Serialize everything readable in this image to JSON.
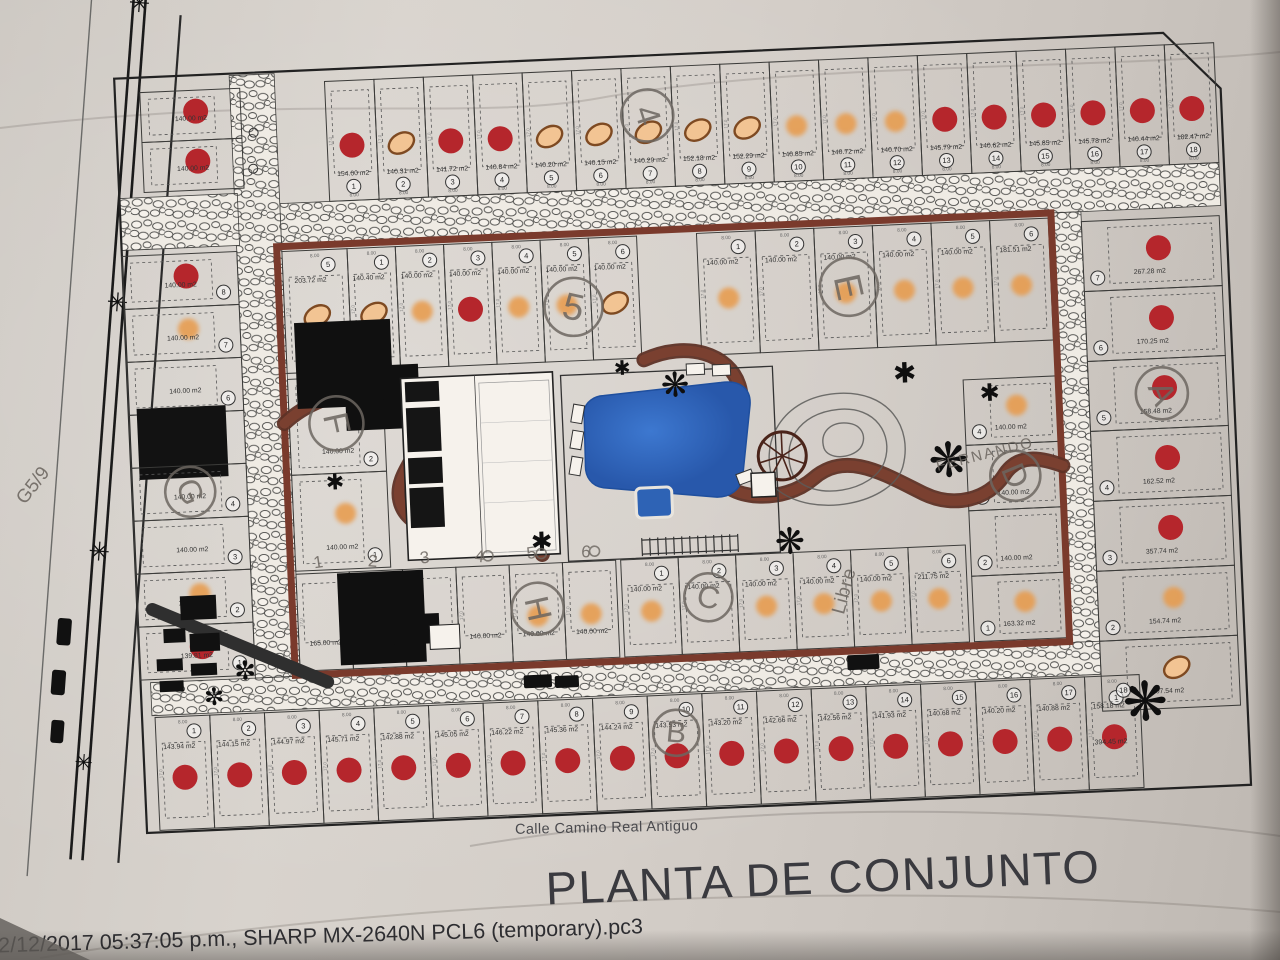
{
  "plan": {
    "title": "PLANTA DE CONJUNTO",
    "street": "Calle Camino Real Antiguo",
    "printer_line": "22/12/2017 05:37:05 p.m., SHARP MX-2640N PCL6 (temporary).pc3",
    "dims": {
      "front": "8.00",
      "side": "17.0"
    },
    "extra": {
      "green_area": "394.45 m2"
    },
    "legend_semantics": {
      "red_dot": "lot-marker-red",
      "orange_dot": "lot-marker-orange",
      "tan_oval": "lot-marker-outlined-oval"
    },
    "groups": {
      "top_row": {
        "dim": "8.00",
        "lots": [
          {
            "n": "1",
            "area": "154.00 m2",
            "marker": "red"
          },
          {
            "n": "2",
            "area": "140.31 m2",
            "marker": "tan"
          },
          {
            "n": "3",
            "area": "141.72 m2",
            "marker": "red"
          },
          {
            "n": "4",
            "area": "140.84 m2",
            "marker": "red"
          },
          {
            "n": "5",
            "area": "140.20 m2",
            "marker": "tan"
          },
          {
            "n": "6",
            "area": "140.15 m2",
            "marker": "tan"
          },
          {
            "n": "7",
            "area": "140.29 m2",
            "marker": "tan"
          },
          {
            "n": "8",
            "area": "152.18 m2",
            "marker": "tan"
          },
          {
            "n": "9",
            "area": "152.29 m2",
            "marker": "tan"
          },
          {
            "n": "10",
            "area": "140.85 m2",
            "marker": "orange"
          },
          {
            "n": "11",
            "area": "140.72 m2",
            "marker": "orange"
          },
          {
            "n": "12",
            "area": "140.70 m2",
            "marker": "orange"
          },
          {
            "n": "13",
            "area": "145.79 m2",
            "marker": "red"
          },
          {
            "n": "14",
            "area": "140.62 m2",
            "marker": "red"
          },
          {
            "n": "15",
            "area": "145.85 m2",
            "marker": "red"
          },
          {
            "n": "16",
            "area": "145.78 m2",
            "marker": "red"
          },
          {
            "n": "17",
            "area": "140.44 m2",
            "marker": "red"
          },
          {
            "n": "18",
            "area": "182.47 m2",
            "marker": "red"
          }
        ]
      },
      "corner_block": {
        "lots": [
          {
            "n": "",
            "area": "140.00 m2",
            "marker": "red"
          },
          {
            "n": "",
            "area": "140.00 m2",
            "marker": "red"
          }
        ]
      },
      "left_col": {
        "lots": [
          {
            "n": "8",
            "area": "140.00 m2",
            "marker": "red"
          },
          {
            "n": "7",
            "area": "140.00 m2",
            "marker": "orange"
          },
          {
            "n": "6",
            "area": "140.00 m2",
            "marker": "none"
          },
          {
            "n": "5",
            "area": "",
            "marker": "building"
          },
          {
            "n": "4",
            "area": "140.00 m2",
            "marker": "none"
          },
          {
            "n": "3",
            "area": "140.00 m2",
            "marker": "none"
          },
          {
            "n": "2",
            "area": "140.00 m2",
            "marker": "orange"
          },
          {
            "n": "1",
            "area": "139.81 m2",
            "marker": "red"
          }
        ]
      },
      "right_col": {
        "lots": [
          {
            "n": "7",
            "area": "267.28 m2",
            "marker": "red"
          },
          {
            "n": "6",
            "area": "170.25 m2",
            "marker": "red"
          },
          {
            "n": "5",
            "area": "158.48 m2",
            "marker": "red"
          },
          {
            "n": "4",
            "area": "162.52 m2",
            "marker": "red"
          },
          {
            "n": "3",
            "area": "357.74 m2",
            "marker": "red"
          },
          {
            "n": "2",
            "area": "154.74 m2",
            "marker": "orange"
          },
          {
            "n": "1",
            "area": "207.54 m2",
            "marker": "tan"
          }
        ]
      },
      "bottom_row": {
        "dim": "8.00",
        "lots": [
          {
            "n": "1",
            "area": "143.94 m2",
            "marker": "red"
          },
          {
            "n": "2",
            "area": "144.15 m2",
            "marker": "red"
          },
          {
            "n": "3",
            "area": "144.97 m2",
            "marker": "red"
          },
          {
            "n": "4",
            "area": "145.71 m2",
            "marker": "red"
          },
          {
            "n": "5",
            "area": "142.88 m2",
            "marker": "red"
          },
          {
            "n": "6",
            "area": "145.05 m2",
            "marker": "red"
          },
          {
            "n": "7",
            "area": "146.22 m2",
            "marker": "red"
          },
          {
            "n": "8",
            "area": "145.36 m2",
            "marker": "red"
          },
          {
            "n": "9",
            "area": "144.24 m2",
            "marker": "red"
          },
          {
            "n": "10",
            "area": "143.53 m2",
            "marker": "red"
          },
          {
            "n": "11",
            "area": "143.20 m2",
            "marker": "red"
          },
          {
            "n": "12",
            "area": "142.66 m2",
            "marker": "red"
          },
          {
            "n": "13",
            "area": "142.56 m2",
            "marker": "red"
          },
          {
            "n": "14",
            "area": "141.93 m2",
            "marker": "red"
          },
          {
            "n": "15",
            "area": "140.68 m2",
            "marker": "red"
          },
          {
            "n": "16",
            "area": "140.20 m2",
            "marker": "red"
          },
          {
            "n": "17",
            "area": "140.88 m2",
            "marker": "red"
          },
          {
            "n": "18",
            "area": "158.18 m2",
            "marker": "red"
          }
        ]
      },
      "g_row": {
        "dim": "8.00",
        "lots": [
          {
            "n": "5",
            "area": "203.72 m2",
            "marker": "tan"
          },
          {
            "n": "1",
            "area": "140.40 m2",
            "marker": "tan"
          },
          {
            "n": "2",
            "area": "140.00 m2",
            "marker": "orange"
          },
          {
            "n": "3",
            "area": "140.00 m2",
            "marker": "red"
          },
          {
            "n": "4",
            "area": "140.00 m2",
            "marker": "orange"
          },
          {
            "n": "5",
            "area": "140.00 m2",
            "marker": "orange"
          },
          {
            "n": "6",
            "area": "140.00 m2",
            "marker": "tan"
          }
        ]
      },
      "e_row": {
        "dim": "8.00",
        "lots": [
          {
            "n": "1",
            "area": "140.00 m2",
            "marker": "orange"
          },
          {
            "n": "2",
            "area": "140.00 m2",
            "marker": "none"
          },
          {
            "n": "3",
            "area": "140.00 m2",
            "marker": "orange"
          },
          {
            "n": "4",
            "area": "140.00 m2",
            "marker": "orange"
          },
          {
            "n": "5",
            "area": "140.00 m2",
            "marker": "orange"
          },
          {
            "n": "6",
            "area": "181.51 m2",
            "marker": "orange"
          }
        ]
      },
      "f_col": {
        "lots": [
          {
            "n": "2",
            "area": "140.00 m2",
            "marker": "none"
          },
          {
            "n": "1",
            "area": "140.00 m2",
            "marker": "orange"
          }
        ]
      },
      "h_row": {
        "lots": [
          {
            "n": "",
            "area": "165.00 m2",
            "marker": "none"
          },
          {
            "n": "",
            "area": "140.00 m2",
            "marker": "none"
          },
          {
            "n": "",
            "area": "140.00 m2",
            "marker": "none"
          },
          {
            "n": "",
            "area": "140.00 m2",
            "marker": "none"
          },
          {
            "n": "",
            "area": "140.00 m2",
            "marker": "orange"
          },
          {
            "n": "",
            "area": "140.00 m2",
            "marker": "orange"
          }
        ]
      },
      "c_row": {
        "dim": "8.00",
        "lots": [
          {
            "n": "1",
            "area": "140.00 m2",
            "marker": "orange"
          },
          {
            "n": "2",
            "area": "140.00 m2",
            "marker": "none"
          },
          {
            "n": "3",
            "area": "140.00 m2",
            "marker": "orange"
          },
          {
            "n": "4",
            "area": "140.00 m2",
            "marker": "orange"
          },
          {
            "n": "5",
            "area": "140.00 m2",
            "marker": "orange"
          },
          {
            "n": "6",
            "area": "211.75 m2",
            "marker": "orange"
          }
        ]
      },
      "d_col": {
        "lots": [
          {
            "n": "4",
            "area": "140.00 m2",
            "marker": "orange"
          },
          {
            "n": "3",
            "area": "140.00 m2",
            "marker": "none"
          },
          {
            "n": "2",
            "area": "140.00 m2",
            "marker": "none"
          },
          {
            "n": "1",
            "area": "163.32 m2",
            "marker": "orange"
          }
        ]
      }
    },
    "annotations": {
      "circled": [
        {
          "t": "4",
          "x": 576,
          "y": 100,
          "r": 26,
          "rot": 75
        },
        {
          "t": "5",
          "x": 494,
          "y": 288,
          "r": 29,
          "rot": 15
        },
        {
          "t": "E",
          "x": 770,
          "y": 280,
          "r": 29,
          "rot": 80
        },
        {
          "t": "F",
          "x": 252,
          "y": 394,
          "r": 27,
          "rot": 80
        },
        {
          "t": "G",
          "x": 103,
          "y": 456,
          "r": 25,
          "rot": 70
        },
        {
          "t": "H",
          "x": 445,
          "y": 588,
          "r": 26,
          "rot": 80
        },
        {
          "t": "C",
          "x": 616,
          "y": 584,
          "r": 24,
          "rot": 15
        },
        {
          "t": "D",
          "x": 928,
          "y": 476,
          "r": 25,
          "rot": 70
        },
        {
          "t": "A",
          "x": 1078,
          "y": 400,
          "r": 26,
          "rot": 70
        },
        {
          "t": "B",
          "x": 578,
          "y": 718,
          "r": 23,
          "rot": 8
        }
      ],
      "pencil_numbers": [
        "1",
        "2",
        "3",
        "4",
        "5",
        "6"
      ],
      "words": {
        "fernando": "FERNANDO",
        "libre": "Libre",
        "margin_note": "G5/9"
      }
    },
    "colors": {
      "red_dot": "#b5262c",
      "orange_dot": "#e89a4a",
      "tan_fill": "#f2c493",
      "tan_stroke": "#7e4a22",
      "road_brown": "#7a4030",
      "road_brown_dark": "#5e3126",
      "block_border": "#7a3a2c",
      "pencil": "#6c6660",
      "pool_blue": "#2e63b5",
      "ink": "#1c1c1c"
    }
  }
}
